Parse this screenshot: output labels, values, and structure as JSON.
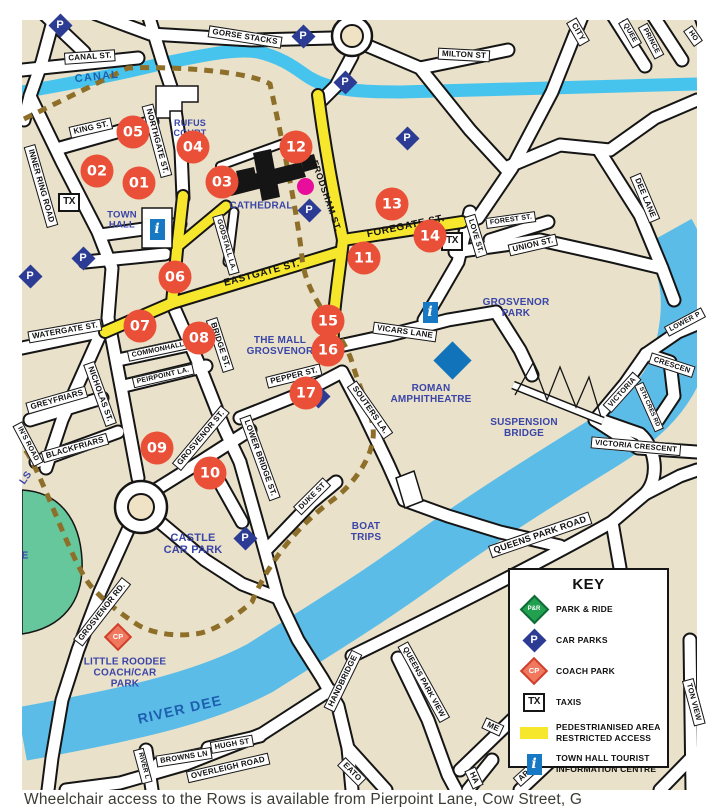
{
  "colors": {
    "bg": "#e9e1c9",
    "canal": "#47c4ee",
    "river": "#5bbce8",
    "pedestrian_yellow": "#f6e72c",
    "wall_dash": "#8e6f2a",
    "marker_red": "#ea4f38",
    "place_blue": "#3a45a8",
    "water_label_blue": "#1d5fae",
    "car_park_blue": "#2c3c94",
    "park_ride_green": "#21a04f",
    "coach_park_red": "#f0785f",
    "info_blue": "#1779c4",
    "pink_dot": "#e90d9b",
    "amphitheatre_blue": "#1173b9",
    "green_space": "#66c79c"
  },
  "icon_glyphs": {
    "car-park": "P",
    "park-ride": "P&R",
    "coach-park": "CP",
    "taxi": "TX",
    "info": "i"
  },
  "streets": [
    {
      "t": "GORSE STACKS",
      "x": 245,
      "y": 37,
      "r": 9
    },
    {
      "t": "CANAL ST.",
      "x": 90,
      "y": 57,
      "r": -4
    },
    {
      "t": "MILTON ST",
      "x": 464,
      "y": 55,
      "r": 3
    },
    {
      "t": "CITY",
      "x": 578,
      "y": 32,
      "r": 60
    },
    {
      "t": "QUEE",
      "x": 630,
      "y": 33,
      "r": 60,
      "fs": 7
    },
    {
      "t": "PRINCE",
      "x": 651,
      "y": 41,
      "r": 62,
      "fs": 7
    },
    {
      "t": "HO",
      "x": 693,
      "y": 36,
      "r": 55,
      "fs": 7
    },
    {
      "t": "KING ST.",
      "x": 91,
      "y": 128,
      "r": -13
    },
    {
      "t": "NORTHGATE ST.",
      "x": 157,
      "y": 141,
      "r": 75
    },
    {
      "t": "INNER RING ROAD",
      "x": 41,
      "y": 186,
      "r": 74
    },
    {
      "t": "DEE LANE",
      "x": 645,
      "y": 198,
      "r": 67
    },
    {
      "t": "FOREST ST.",
      "x": 511,
      "y": 220,
      "r": -8,
      "fs": 7
    },
    {
      "t": "UNION ST.",
      "x": 533,
      "y": 245,
      "r": -13
    },
    {
      "t": "LOVE ST.",
      "x": 476,
      "y": 236,
      "r": 73,
      "fs": 7.5
    },
    {
      "t": "GODSTALL LA.",
      "x": 226,
      "y": 245,
      "r": 74,
      "fs": 7
    },
    {
      "t": "WATERGATE ST.",
      "x": 65,
      "y": 331,
      "r": -10
    },
    {
      "t": "NICHOLAS ST.",
      "x": 100,
      "y": 394,
      "r": 70
    },
    {
      "t": "COMMONHALL",
      "x": 158,
      "y": 350,
      "r": -12,
      "fs": 7
    },
    {
      "t": "PEIRPOINT LA.",
      "x": 163,
      "y": 376,
      "r": -13,
      "fs": 7
    },
    {
      "t": "BRIDGE ST.",
      "x": 220,
      "y": 345,
      "r": 72
    },
    {
      "t": "GREYFRIARS",
      "x": 57,
      "y": 400,
      "r": -16
    },
    {
      "t": "BLACKFRIARS",
      "x": 75,
      "y": 448,
      "r": -16
    },
    {
      "t": "IN'S ROAD",
      "x": 28,
      "y": 444,
      "r": 62,
      "fs": 7
    },
    {
      "t": "GROSVENOR ST.",
      "x": 201,
      "y": 438,
      "r": -50
    },
    {
      "t": "VICARS LANE",
      "x": 405,
      "y": 332,
      "r": 8
    },
    {
      "t": "SOUTERS LA.",
      "x": 370,
      "y": 410,
      "r": 55
    },
    {
      "t": "PEPPER ST.",
      "x": 294,
      "y": 376,
      "r": -14
    },
    {
      "t": "DUKE ST",
      "x": 312,
      "y": 496,
      "r": -45,
      "fs": 7.5
    },
    {
      "t": "LOWER BRIDGE ST.",
      "x": 260,
      "y": 458,
      "r": 70
    },
    {
      "t": "GROSVENOR RD.",
      "x": 102,
      "y": 612,
      "r": -52
    },
    {
      "t": "QUEENS PARK ROAD",
      "x": 540,
      "y": 535,
      "r": -19,
      "fs": 9
    },
    {
      "t": "VICTORIA CRESCENT",
      "x": 636,
      "y": 446,
      "r": 5,
      "fs": 7.5
    },
    {
      "t": "VICTORIA",
      "x": 622,
      "y": 392,
      "r": -48,
      "fs": 7.5
    },
    {
      "t": "CRESCEN",
      "x": 672,
      "y": 365,
      "r": 18,
      "fs": 7.5
    },
    {
      "t": "STH CRES RD",
      "x": 649,
      "y": 407,
      "r": 66,
      "fs": 6
    },
    {
      "t": "LOWER P",
      "x": 685,
      "y": 322,
      "r": -28,
      "fs": 7
    },
    {
      "t": "HANDBRIDGE",
      "x": 343,
      "y": 681,
      "r": -64
    },
    {
      "t": "QUEENS PARK VIEW",
      "x": 424,
      "y": 682,
      "r": 61,
      "fs": 7.5
    },
    {
      "t": "EATO",
      "x": 352,
      "y": 772,
      "r": 45
    },
    {
      "t": "OVERLEIGH ROAD",
      "x": 228,
      "y": 768,
      "r": -13
    },
    {
      "t": "HUGH ST",
      "x": 232,
      "y": 744,
      "r": -10,
      "fs": 7.5
    },
    {
      "t": "BROWNS LN",
      "x": 184,
      "y": 757,
      "r": -9,
      "fs": 7.5
    },
    {
      "t": "RIVER L",
      "x": 143,
      "y": 766,
      "r": 75,
      "fs": 6.5
    },
    {
      "t": "TON VIEW",
      "x": 694,
      "y": 702,
      "r": 75,
      "fs": 7.5
    },
    {
      "t": "ME",
      "x": 493,
      "y": 727,
      "r": 25
    },
    {
      "t": "HA",
      "x": 474,
      "y": 778,
      "r": 65
    },
    {
      "t": "AP",
      "x": 524,
      "y": 776,
      "r": -42
    },
    {
      "t": "FRODSHAM ST.",
      "x": 326,
      "y": 196,
      "r": 71,
      "cls": "plain",
      "fs": 9
    },
    {
      "t": "FOREGATE ST.",
      "x": 406,
      "y": 227,
      "r": -12,
      "cls": "plain"
    },
    {
      "t": "EASTGATE ST.",
      "x": 262,
      "y": 274,
      "r": -15,
      "cls": "plain"
    }
  ],
  "places": [
    {
      "t": "RUFUS\nCOURT",
      "x": 190,
      "y": 129,
      "fs": 9
    },
    {
      "t": "TOWN\nHALL",
      "x": 122,
      "y": 221,
      "fs": 9.5
    },
    {
      "t": "CATHEDRAL",
      "x": 261,
      "y": 206,
      "fs": 10
    },
    {
      "t": "THE MALL\nGROSVENOR",
      "x": 280,
      "y": 346,
      "fs": 10
    },
    {
      "t": "GROSVENOR\nPARK",
      "x": 516,
      "y": 308,
      "fs": 10
    },
    {
      "t": "ROMAN\nAMPHITHEATRE",
      "x": 431,
      "y": 394,
      "fs": 10
    },
    {
      "t": "SUSPENSION\nBRIDGE",
      "x": 524,
      "y": 428,
      "fs": 10
    },
    {
      "t": "CASTLE\nCAR PARK",
      "x": 193,
      "y": 544,
      "fs": 11
    },
    {
      "t": "LITTLE ROODEE\nCOACH/CAR\nPARK",
      "x": 125,
      "y": 673,
      "fs": 10
    },
    {
      "t": "BOAT\nTRIPS",
      "x": 366,
      "y": 532,
      "fs": 10
    },
    {
      "t": "CANAL",
      "x": 97,
      "y": 77,
      "r": -6,
      "fs": 11,
      "cls": "water"
    },
    {
      "t": "RIVER DEE",
      "x": 180,
      "y": 710,
      "r": -13,
      "fs": 14,
      "cls": "water big"
    },
    {
      "t": "LS",
      "x": 26,
      "y": 478,
      "r": -55,
      "fs": 10
    },
    {
      "t": "E",
      "x": 25,
      "y": 556,
      "fs": 10
    }
  ],
  "icons": [
    {
      "k": "car-park",
      "x": 60,
      "y": 25
    },
    {
      "k": "car-park",
      "x": 303,
      "y": 36
    },
    {
      "k": "car-park",
      "x": 345,
      "y": 82
    },
    {
      "k": "car-park",
      "x": 407,
      "y": 138
    },
    {
      "k": "car-park",
      "x": 309,
      "y": 210
    },
    {
      "k": "car-park",
      "x": 83,
      "y": 258
    },
    {
      "k": "car-park",
      "x": 30,
      "y": 276
    },
    {
      "k": "car-park",
      "x": 245,
      "y": 538
    },
    {
      "k": "car-park",
      "x": 318,
      "y": 396
    },
    {
      "k": "taxi",
      "x": 69,
      "y": 202
    },
    {
      "k": "taxi",
      "x": 452,
      "y": 241
    },
    {
      "k": "info",
      "x": 157,
      "y": 229
    },
    {
      "k": "info",
      "x": 430,
      "y": 312
    },
    {
      "k": "coach-park",
      "x": 118,
      "y": 637
    },
    {
      "k": "pink-dot",
      "x": 305,
      "y": 186
    },
    {
      "k": "blue-diamond",
      "x": 452,
      "y": 360
    }
  ],
  "markers": [
    {
      "n": "01",
      "x": 139,
      "y": 183
    },
    {
      "n": "02",
      "x": 97,
      "y": 171
    },
    {
      "n": "03",
      "x": 222,
      "y": 182
    },
    {
      "n": "04",
      "x": 193,
      "y": 147
    },
    {
      "n": "05",
      "x": 133,
      "y": 132
    },
    {
      "n": "06",
      "x": 175,
      "y": 277
    },
    {
      "n": "07",
      "x": 140,
      "y": 326
    },
    {
      "n": "08",
      "x": 199,
      "y": 338
    },
    {
      "n": "09",
      "x": 157,
      "y": 448
    },
    {
      "n": "10",
      "x": 210,
      "y": 473
    },
    {
      "n": "11",
      "x": 364,
      "y": 258
    },
    {
      "n": "12",
      "x": 296,
      "y": 147
    },
    {
      "n": "13",
      "x": 392,
      "y": 204
    },
    {
      "n": "14",
      "x": 430,
      "y": 236
    },
    {
      "n": "15",
      "x": 328,
      "y": 321
    },
    {
      "n": "16",
      "x": 328,
      "y": 350
    },
    {
      "n": "17",
      "x": 306,
      "y": 393
    }
  ],
  "key": {
    "title": "KEY",
    "items": [
      {
        "k": "park-ride",
        "t": "PARK & RIDE"
      },
      {
        "k": "car-park",
        "t": "CAR PARKS"
      },
      {
        "k": "coach-park",
        "t": "COACH PARK"
      },
      {
        "k": "taxi",
        "t": "TAXIS"
      },
      {
        "k": "pedestrian",
        "t": "PEDESTRIANISED AREA\nRESTRICTED ACCESS"
      },
      {
        "k": "info",
        "t": "TOWN HALL TOURIST\nINFORMATION CENTRE"
      }
    ]
  },
  "caption": "Wheelchair access to the Rows is available from Pierpoint Lane, Cow Street, G"
}
